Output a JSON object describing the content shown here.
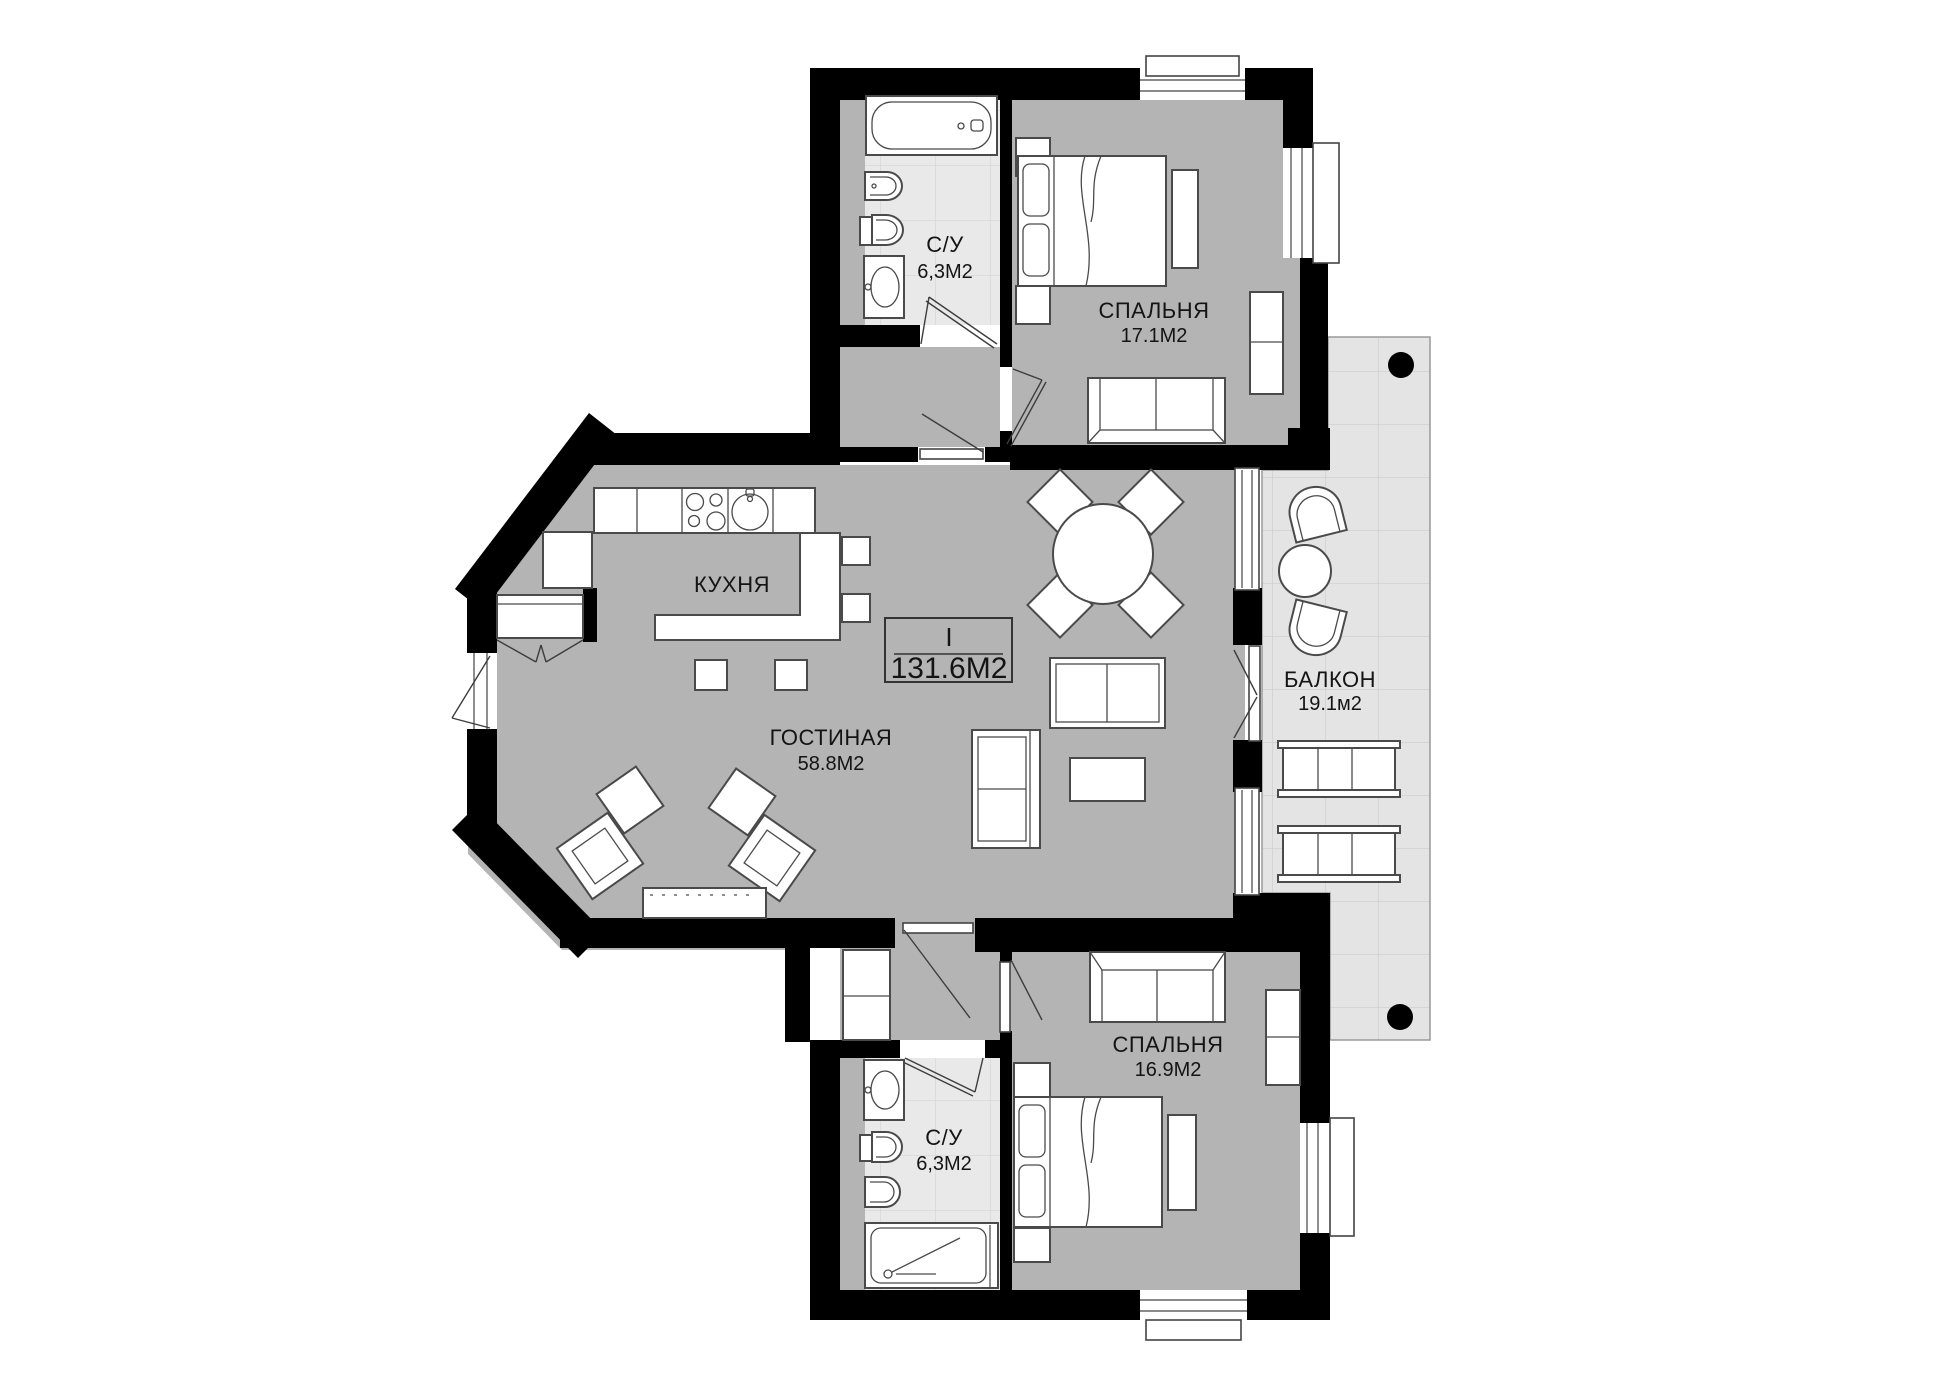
{
  "plan": {
    "unit": {
      "floor_mark": "I",
      "total_area": "131.6М2"
    },
    "rooms": {
      "bathroom_top": {
        "name": "С/У",
        "area": "6,3М2"
      },
      "bedroom_top": {
        "name": "СПАЛЬНЯ",
        "area": "17.1М2"
      },
      "kitchen": {
        "name": "КУХНЯ"
      },
      "living": {
        "name": "ГОСТИНАЯ",
        "area": "58.8М2"
      },
      "balcony": {
        "name": "БАЛКОН",
        "area": "19.1м2"
      },
      "bedroom_bottom": {
        "name": "СПАЛЬНЯ",
        "area": "16.9М2"
      },
      "bathroom_bottom": {
        "name": "С/У",
        "area": "6,3М2"
      }
    },
    "colors": {
      "wall": "#000000",
      "room_floor": "#b4b4b4",
      "bath_floor": "#e9e9e9",
      "balcony_floor": "#e4e4e4",
      "furniture_outline": "#4a4a4a",
      "text": "#141414"
    }
  }
}
